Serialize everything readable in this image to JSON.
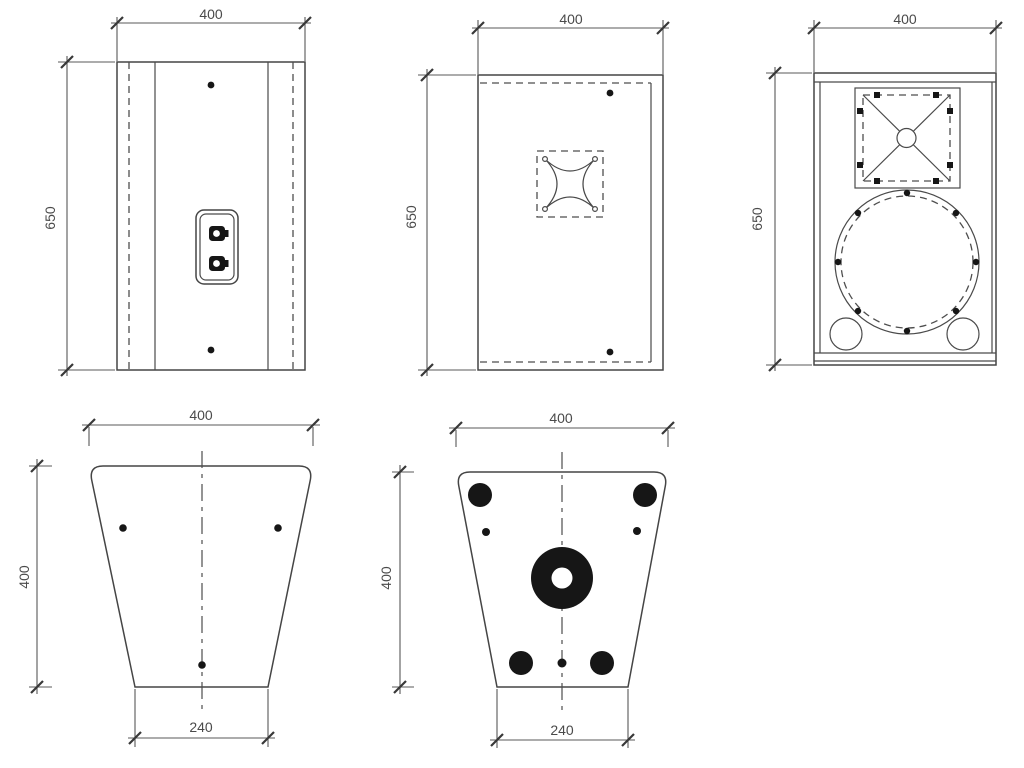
{
  "drawing": {
    "background": "#ffffff",
    "line_color": "#454545",
    "dim_color": "#585858",
    "fill_color": "#161616",
    "views": {
      "back": {
        "width": "400",
        "height": "650"
      },
      "side": {
        "width": "400",
        "height": "650"
      },
      "front": {
        "width": "400",
        "height": "650"
      },
      "top": {
        "width": "400",
        "depth": "400",
        "base": "240"
      },
      "bottom": {
        "width": "400",
        "depth": "400",
        "base": "240"
      }
    }
  }
}
